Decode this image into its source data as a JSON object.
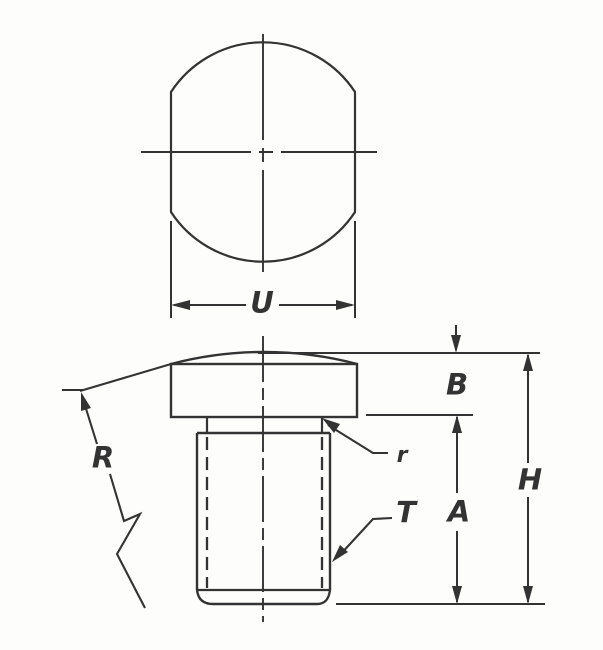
{
  "colors": {
    "line": "#333333",
    "paper": "#fdfdfc"
  },
  "labels": {
    "head_width": "U",
    "head_height": "B",
    "crown_radius": "R",
    "fillet_radius": "r",
    "thread": "T",
    "shank_length": "A",
    "overall_height": "H"
  }
}
